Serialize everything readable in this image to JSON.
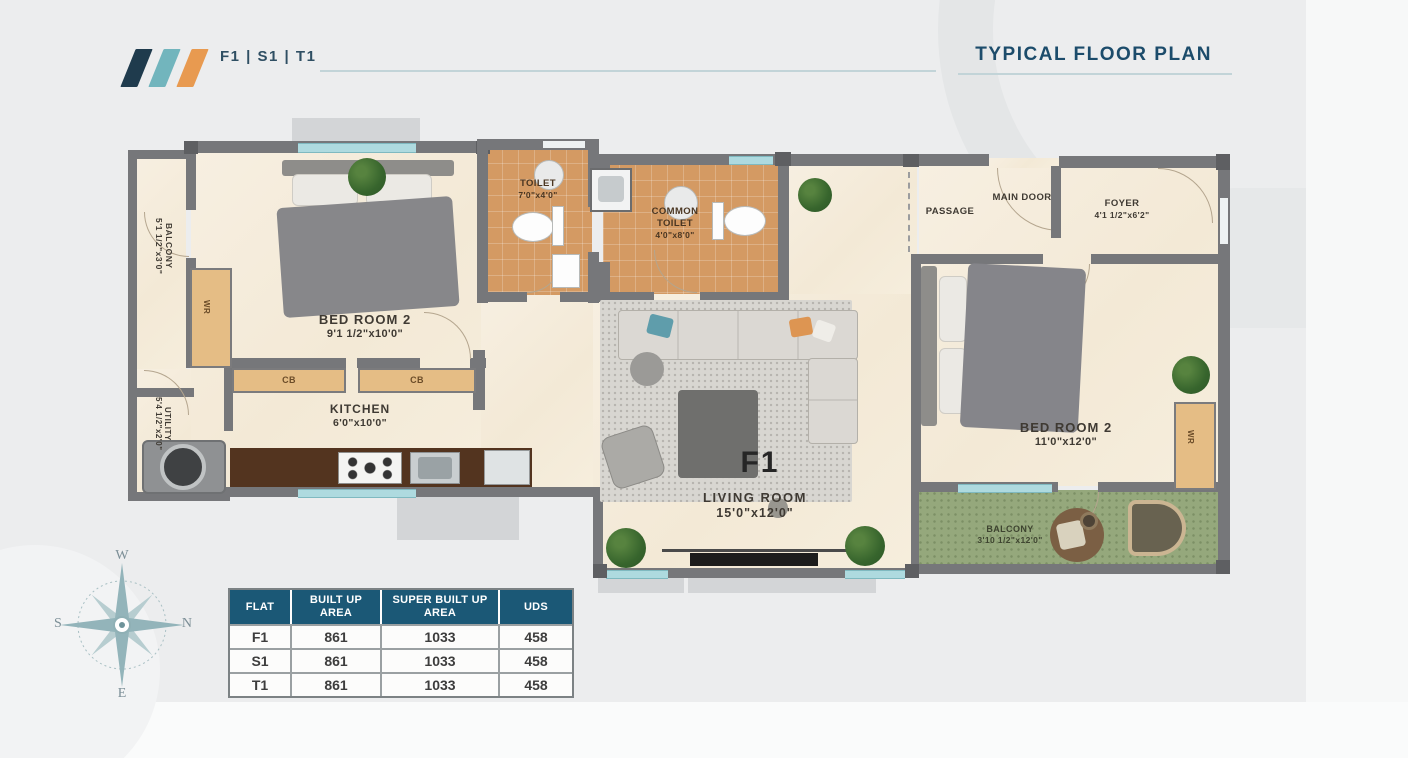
{
  "header": {
    "flat_codes": "F1 | S1 | T1",
    "title": "TYPICAL FLOOR PLAN",
    "logo_colors": {
      "bar1": "#1f3b4d",
      "bar2": "#72b5bd",
      "bar3": "#e89a50"
    }
  },
  "plan": {
    "unit_label": "F1",
    "wardrobe_label": "WR",
    "cabinet_label": "CB",
    "rooms": [
      {
        "name": "BALCONY",
        "dims": "5'1 1/2\"x3'0\""
      },
      {
        "name": "BED ROOM 2",
        "dims": "9'1 1/2\"x10'0\""
      },
      {
        "name": "TOILET",
        "dims": "7'0\"x4'0\""
      },
      {
        "name": "COMMON TOILET",
        "dims": "4'0\"x8'0\""
      },
      {
        "name": "PASSAGE",
        "dims": ""
      },
      {
        "name": "MAIN DOOR",
        "dims": ""
      },
      {
        "name": "FOYER",
        "dims": "4'1 1/2\"x6'2\""
      },
      {
        "name": "BED ROOM 2",
        "dims": "11'0\"x12'0\""
      },
      {
        "name": "KITCHEN",
        "dims": "6'0\"x10'0\""
      },
      {
        "name": "UTILITY",
        "dims": "5'4 1/2\"x2'0\""
      },
      {
        "name": "LIVING ROOM",
        "dims": "15'0\"x12'0\""
      },
      {
        "name": "BALCONY",
        "dims": "3'10 1/2\"x12'0\""
      }
    ],
    "compass": {
      "top": "W",
      "right": "N",
      "left": "S",
      "bottom": "E"
    }
  },
  "area_table": {
    "headers": [
      "FLAT",
      "BUILT UP AREA",
      "SUPER BUILT UP AREA",
      "UDS"
    ],
    "rows": [
      {
        "flat": "F1",
        "built_up": "861",
        "super_built_up": "1033",
        "uds": "458"
      },
      {
        "flat": "S1",
        "built_up": "861",
        "super_built_up": "1033",
        "uds": "458"
      },
      {
        "flat": "T1",
        "built_up": "861",
        "super_built_up": "1033",
        "uds": "458"
      }
    ]
  }
}
